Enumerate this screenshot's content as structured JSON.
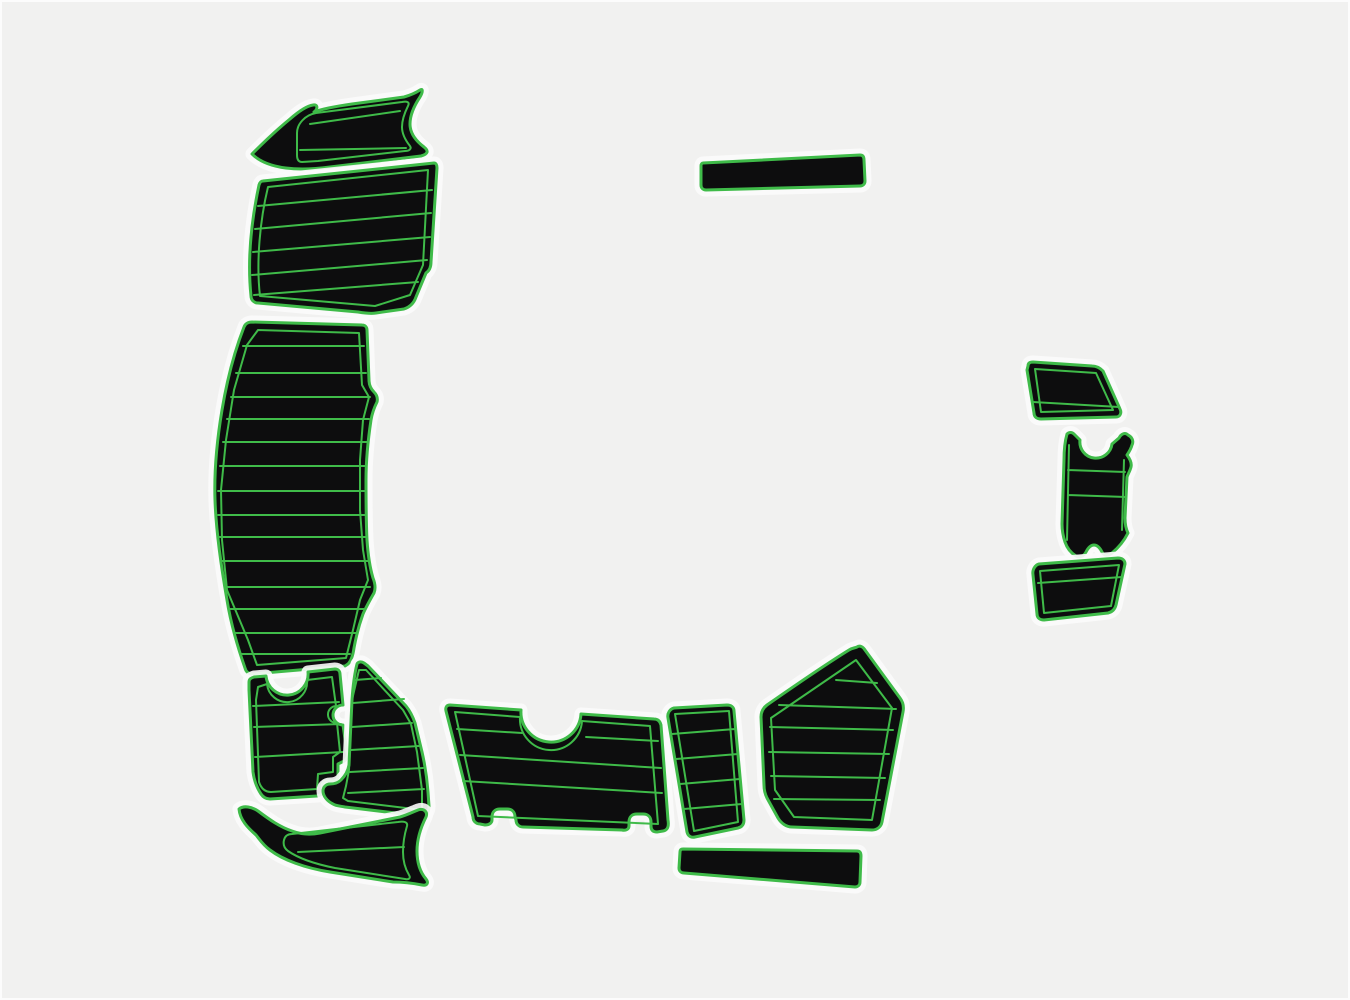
{
  "image": {
    "type": "product-photo",
    "subject": "marine EVA foam boat decking pad set, black with green trim, top view layout",
    "colors": {
      "background": "#f1f1f0",
      "pad": "#0d0d0e",
      "trim": "#3fbb49",
      "halo": "#fcfcfc"
    },
    "pieces": [
      {
        "id": "pad-bow-wing-top-left",
        "label": "curved bow step pad (top left)"
      },
      {
        "id": "pad-foredeck-upper",
        "label": "striped foredeck pad"
      },
      {
        "id": "pad-side-deck-long",
        "label": "long curved side-deck pad"
      },
      {
        "id": "pad-cockpit-notched",
        "label": "notched cockpit pad"
      },
      {
        "id": "pad-cockpit-corner",
        "label": "cockpit corner pad with foot"
      },
      {
        "id": "pad-bow-wing-bottom-left",
        "label": "curved step pad (bottom left)"
      },
      {
        "id": "pad-transom-wide",
        "label": "wide transom pad with U-notch"
      },
      {
        "id": "pad-step-narrow",
        "label": "narrow striped step pad"
      },
      {
        "id": "pad-trim-strip",
        "label": "long thin trim strip"
      },
      {
        "id": "pad-helm-shield",
        "label": "pentagon helm pad"
      },
      {
        "id": "pad-step-top-right",
        "label": "angled step pad (right top)"
      },
      {
        "id": "pad-engine-bracket",
        "label": "contoured bracket pad (right middle)"
      },
      {
        "id": "pad-step-bottom-right",
        "label": "angled step pad (right bottom)"
      },
      {
        "id": "pad-plain-bar",
        "label": "plain rectangular bar pad"
      }
    ]
  }
}
